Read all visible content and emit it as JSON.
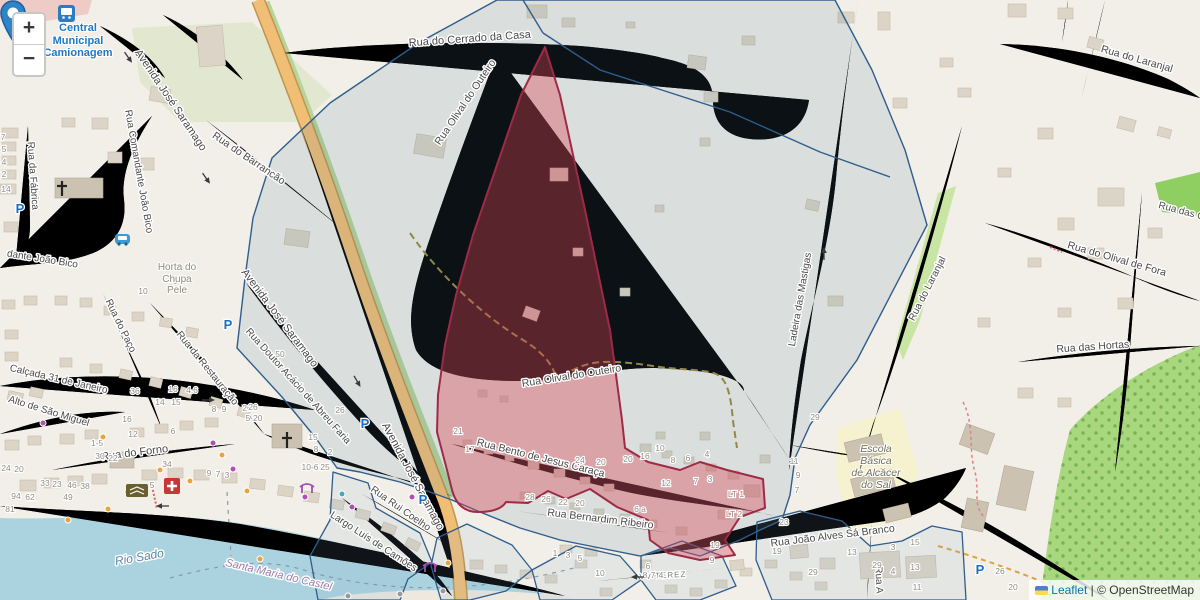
{
  "map": {
    "controls": {
      "zoom_in": "+",
      "zoom_out": "−"
    },
    "attribution": {
      "leaflet": "Leaflet",
      "separator": "|",
      "osm": "© OpenStreetMap"
    }
  },
  "colors": {
    "highlight_fill": "#efa4ac",
    "highlight_stroke": "#9e2b45",
    "boundary_stroke": "#2f5d8c",
    "boundary_area": "#dfe3e4",
    "water": "#abd3df",
    "road_primary": "#f1be76",
    "marker_blue": "#2d84c8",
    "leaflet_link": "#0078a8"
  },
  "place_labels": {
    "bus_station": "Central\nMunicipal\nCamionagem",
    "school": "Escola\nBásica\nde Alcácer\ndo Sal",
    "farm": "Horta do\nChupa\nPele"
  },
  "street_labels": [
    {
      "text": "Rua do Cerrado da Casa",
      "x": 470,
      "y": 42,
      "rot": -4,
      "size": 11
    },
    {
      "text": "Rua Olival do Outeiro",
      "x": 468,
      "y": 104,
      "rot": -56,
      "size": 10.5
    },
    {
      "text": "Rua Olival do Outeiro",
      "x": 572,
      "y": 379,
      "rot": -9,
      "size": 10.5
    },
    {
      "text": "Rua do Barrancão",
      "x": 247,
      "y": 161,
      "rot": 34,
      "size": 10.5
    },
    {
      "text": "Avenida José Saramago",
      "x": 168,
      "y": 102,
      "rot": 56,
      "size": 11
    },
    {
      "text": "Avenida José Saramago",
      "x": 277,
      "y": 320,
      "rot": 53,
      "size": 11
    },
    {
      "text": "Avenida José Saramago",
      "x": 410,
      "y": 478,
      "rot": 62,
      "size": 11
    },
    {
      "text": "Rua Comandante João Bico",
      "x": 136,
      "y": 172,
      "rot": 80,
      "size": 10
    },
    {
      "text": "dante João Bico",
      "x": 42,
      "y": 262,
      "rot": 9,
      "size": 10
    },
    {
      "text": "Rua da Fábrica",
      "x": 30,
      "y": 176,
      "rot": 86,
      "size": 10
    },
    {
      "text": "Rua do Paço",
      "x": 118,
      "y": 327,
      "rot": 64,
      "size": 10
    },
    {
      "text": "Rua da Restauração",
      "x": 205,
      "y": 370,
      "rot": 51,
      "size": 10
    },
    {
      "text": "Rua Doutor Acácio de Abreu Faria",
      "x": 296,
      "y": 388,
      "rot": 48,
      "size": 10
    },
    {
      "text": "Calçada 31 de Janeiro",
      "x": 58,
      "y": 382,
      "rot": 13,
      "size": 10
    },
    {
      "text": "Alto de São Miguel",
      "x": 48,
      "y": 414,
      "rot": 17,
      "size": 10
    },
    {
      "text": "Rua do Forno",
      "x": 135,
      "y": 456,
      "rot": -7,
      "size": 11
    },
    {
      "text": "Rua Bento de Jesus Caraça",
      "x": 540,
      "y": 461,
      "rot": 14,
      "size": 10.5
    },
    {
      "text": "Rua Bernardim Ribeiro",
      "x": 600,
      "y": 522,
      "rot": 7,
      "size": 10.5
    },
    {
      "text": "Rua João Alves Sá Branco",
      "x": 833,
      "y": 539,
      "rot": -7,
      "size": 10.5
    },
    {
      "text": "VV TEREZ",
      "x": 663,
      "y": 578,
      "rot": -3,
      "size": 8,
      "cls": "minor"
    },
    {
      "text": "Largo Luís de Camões",
      "x": 372,
      "y": 544,
      "rot": 33,
      "size": 10
    },
    {
      "text": "Rua Rui Coelho",
      "x": 399,
      "y": 511,
      "rot": 35,
      "size": 10
    },
    {
      "text": "Ladeira das Mastigas",
      "x": 803,
      "y": 300,
      "rot": -80,
      "size": 10
    },
    {
      "text": "Rua do Laranjal",
      "x": 930,
      "y": 290,
      "rot": -63,
      "size": 10
    },
    {
      "text": "Rua do Laranjal",
      "x": 1136,
      "y": 62,
      "rot": 16,
      "size": 10.5
    },
    {
      "text": "Rua das O",
      "x": 1181,
      "y": 214,
      "rot": 15,
      "size": 10
    },
    {
      "text": "Rua do Olival de Fora",
      "x": 1116,
      "y": 262,
      "rot": 16,
      "size": 10.5
    },
    {
      "text": "Rua das Hortas",
      "x": 1093,
      "y": 350,
      "rot": -4,
      "size": 10.5
    },
    {
      "text": "Rua A",
      "x": 876,
      "y": 580,
      "rot": 88,
      "size": 10
    },
    {
      "text": "Rio Sado",
      "x": 140,
      "y": 561,
      "rot": -10,
      "size": 12,
      "cls": "water"
    },
    {
      "text": "Santa Maria do Castel",
      "x": 278,
      "y": 578,
      "rot": 13,
      "size": 11,
      "cls": "admin"
    }
  ],
  "house_numbers": [
    {
      "t": "7",
      "x": 3,
      "y": 140
    },
    {
      "t": "5",
      "x": 4,
      "y": 152
    },
    {
      "t": "4",
      "x": 4,
      "y": 165
    },
    {
      "t": "2",
      "x": 4,
      "y": 177
    },
    {
      "t": "14",
      "x": 6,
      "y": 192
    },
    {
      "t": "10",
      "x": 143,
      "y": 294
    },
    {
      "t": "6",
      "x": 175,
      "y": 284
    },
    {
      "t": "50",
      "x": 280,
      "y": 357
    },
    {
      "t": "36",
      "x": 135,
      "y": 394
    },
    {
      "t": "16",
      "x": 173,
      "y": 392
    },
    {
      "t": "4.6",
      "x": 192,
      "y": 393
    },
    {
      "t": "14",
      "x": 160,
      "y": 405
    },
    {
      "t": "15",
      "x": 176,
      "y": 405
    },
    {
      "t": "16",
      "x": 127,
      "y": 422
    },
    {
      "t": "8",
      "x": 214,
      "y": 412
    },
    {
      "t": "9",
      "x": 224,
      "y": 412
    },
    {
      "t": "26",
      "x": 247,
      "y": 411
    },
    {
      "t": "12",
      "x": 133,
      "y": 437
    },
    {
      "t": "6",
      "x": 173,
      "y": 434
    },
    {
      "t": "1-5",
      "x": 97,
      "y": 446
    },
    {
      "t": "30",
      "x": 100,
      "y": 459
    },
    {
      "t": "22",
      "x": 113,
      "y": 461
    },
    {
      "t": "34",
      "x": 167,
      "y": 467
    },
    {
      "t": "9",
      "x": 209,
      "y": 476
    },
    {
      "t": "7",
      "x": 218,
      "y": 477
    },
    {
      "t": "3",
      "x": 227,
      "y": 478
    },
    {
      "t": "46",
      "x": 72,
      "y": 488
    },
    {
      "t": "38",
      "x": 85,
      "y": 489
    },
    {
      "t": "33",
      "x": 45,
      "y": 486
    },
    {
      "t": "23",
      "x": 57,
      "y": 487
    },
    {
      "t": "5",
      "x": 152,
      "y": 488
    },
    {
      "t": "94",
      "x": 16,
      "y": 499
    },
    {
      "t": "62",
      "x": 30,
      "y": 500
    },
    {
      "t": "49",
      "x": 68,
      "y": 500
    },
    {
      "t": "81",
      "x": 10,
      "y": 512
    },
    {
      "t": "24",
      "x": 6,
      "y": 471
    },
    {
      "t": "20",
      "x": 19,
      "y": 472
    },
    {
      "t": "26",
      "x": 253,
      "y": 410
    },
    {
      "t": "5-20",
      "x": 254,
      "y": 421
    },
    {
      "t": "26",
      "x": 340,
      "y": 413
    },
    {
      "t": "15",
      "x": 313,
      "y": 440
    },
    {
      "t": "8",
      "x": 316,
      "y": 452
    },
    {
      "t": "2",
      "x": 330,
      "y": 455
    },
    {
      "t": "25",
      "x": 325,
      "y": 470
    },
    {
      "t": "10-6",
      "x": 310,
      "y": 470
    },
    {
      "t": "21",
      "x": 458,
      "y": 434
    },
    {
      "t": "17",
      "x": 470,
      "y": 452
    },
    {
      "t": "24",
      "x": 580,
      "y": 463
    },
    {
      "t": "20",
      "x": 601,
      "y": 465
    },
    {
      "t": "20",
      "x": 628,
      "y": 462
    },
    {
      "t": "16",
      "x": 645,
      "y": 459
    },
    {
      "t": "10",
      "x": 660,
      "y": 451
    },
    {
      "t": "8",
      "x": 673,
      "y": 463
    },
    {
      "t": "6",
      "x": 688,
      "y": 461
    },
    {
      "t": "4",
      "x": 707,
      "y": 457
    },
    {
      "t": "12",
      "x": 666,
      "y": 486
    },
    {
      "t": "7",
      "x": 696,
      "y": 484
    },
    {
      "t": "3",
      "x": 710,
      "y": 482
    },
    {
      "t": "28",
      "x": 530,
      "y": 500
    },
    {
      "t": "26",
      "x": 546,
      "y": 502
    },
    {
      "t": "22",
      "x": 563,
      "y": 505
    },
    {
      "t": "20",
      "x": 580,
      "y": 506
    },
    {
      "t": "6 a",
      "x": 640,
      "y": 512
    },
    {
      "t": "LT 1",
      "x": 736,
      "y": 497
    },
    {
      "t": "LT 2",
      "x": 734,
      "y": 517
    },
    {
      "t": "23",
      "x": 784,
      "y": 525
    },
    {
      "t": "19",
      "x": 715,
      "y": 548
    },
    {
      "t": "19",
      "x": 777,
      "y": 554
    },
    {
      "t": "29",
      "x": 877,
      "y": 568
    },
    {
      "t": "10",
      "x": 600,
      "y": 576
    },
    {
      "t": "6",
      "x": 648,
      "y": 569
    },
    {
      "t": "1",
      "x": 555,
      "y": 556
    },
    {
      "t": "3",
      "x": 568,
      "y": 558
    },
    {
      "t": "5",
      "x": 580,
      "y": 561
    },
    {
      "t": "9",
      "x": 712,
      "y": 563
    },
    {
      "t": "8",
      "x": 645,
      "y": 578
    },
    {
      "t": "7",
      "x": 653,
      "y": 578
    },
    {
      "t": "4",
      "x": 661,
      "y": 578
    },
    {
      "t": "29",
      "x": 815,
      "y": 420
    },
    {
      "t": "11",
      "x": 794,
      "y": 464
    },
    {
      "t": "9",
      "x": 798,
      "y": 478
    },
    {
      "t": "7",
      "x": 797,
      "y": 493
    },
    {
      "t": "13",
      "x": 852,
      "y": 555
    },
    {
      "t": "15",
      "x": 915,
      "y": 545
    },
    {
      "t": "3",
      "x": 893,
      "y": 550
    },
    {
      "t": "4",
      "x": 893,
      "y": 574
    },
    {
      "t": "13",
      "x": 915,
      "y": 570
    },
    {
      "t": "11",
      "x": 917,
      "y": 590
    },
    {
      "t": "29",
      "x": 813,
      "y": 575
    },
    {
      "t": "26",
      "x": 1000,
      "y": 574
    },
    {
      "t": "20",
      "x": 1013,
      "y": 590
    }
  ],
  "poi_dots": [
    {
      "x": 43,
      "y": 423,
      "c": "#b14db5"
    },
    {
      "x": 213,
      "y": 443,
      "c": "#b14db5"
    },
    {
      "x": 233,
      "y": 469,
      "c": "#b14db5"
    },
    {
      "x": 128,
      "y": 492,
      "c": "#b14db5"
    },
    {
      "x": 305,
      "y": 497,
      "c": "#b14db5"
    },
    {
      "x": 352,
      "y": 507,
      "c": "#b14db5"
    },
    {
      "x": 412,
      "y": 497,
      "c": "#b14db5"
    },
    {
      "x": 103,
      "y": 437,
      "c": "#e8a33c"
    },
    {
      "x": 190,
      "y": 481,
      "c": "#e8a33c"
    },
    {
      "x": 247,
      "y": 491,
      "c": "#e8a33c"
    },
    {
      "x": 108,
      "y": 509,
      "c": "#e8a33c"
    },
    {
      "x": 68,
      "y": 520,
      "c": "#e8a33c"
    },
    {
      "x": 160,
      "y": 470,
      "c": "#e8a33c"
    },
    {
      "x": 222,
      "y": 455,
      "c": "#e8a33c"
    },
    {
      "x": 260,
      "y": 559,
      "c": "#e8a33c"
    },
    {
      "x": 448,
      "y": 563,
      "c": "#e8a33c"
    },
    {
      "x": 342,
      "y": 494,
      "c": "#4aa6b8"
    },
    {
      "x": 400,
      "y": 594,
      "c": "#9a9a9a"
    },
    {
      "x": 443,
      "y": 591,
      "c": "#9a9a9a"
    },
    {
      "x": 348,
      "y": 596,
      "c": "#9a9a9a"
    }
  ],
  "parking_positions": [
    {
      "x": 20,
      "y": 213
    },
    {
      "x": 228,
      "y": 329
    },
    {
      "x": 365,
      "y": 428
    },
    {
      "x": 423,
      "y": 504
    },
    {
      "x": 980,
      "y": 574
    }
  ],
  "icons": {
    "parking_letter": "P"
  }
}
